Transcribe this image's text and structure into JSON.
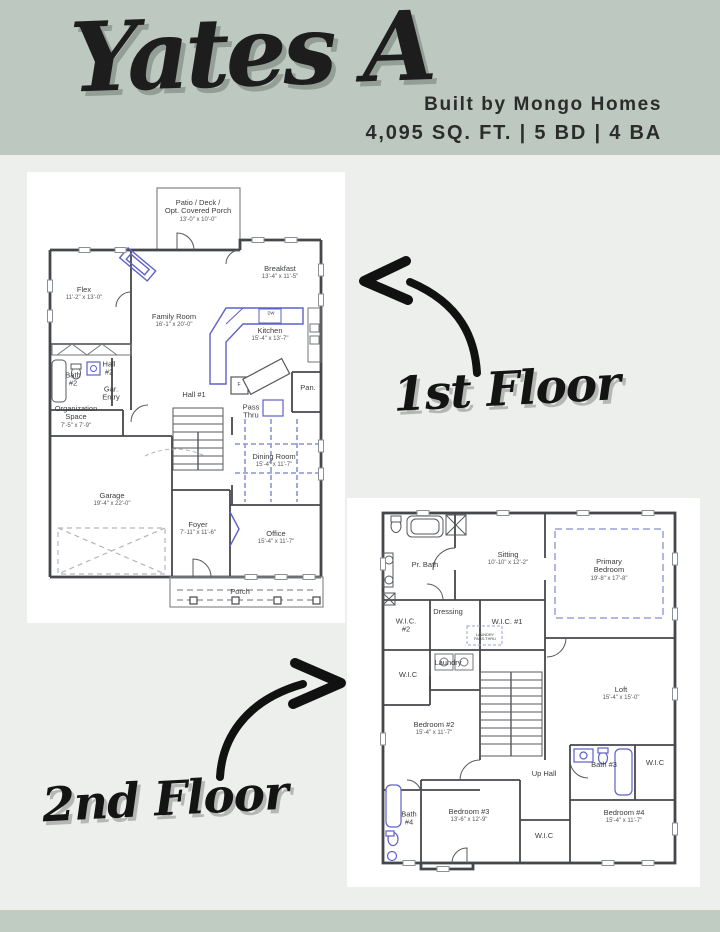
{
  "header": {
    "title": "Yates A",
    "builder": "Built by Mongo Homes",
    "specs": "4,095 SQ. FT. | 5 BD | 4 BA"
  },
  "annotations": {
    "floor1_label": "1st Floor",
    "floor2_label": "2nd Floor"
  },
  "colors": {
    "header_bg": "#bdc8c0",
    "body_bg": "#edefed",
    "footer_bg": "#c0cbc2",
    "panel_bg": "#ffffff",
    "wall": "#45474b",
    "fixture_blue": "#5d61c9",
    "ceiling_dash_blue": "#9aa0d8",
    "ink": "#1d1d1d"
  },
  "floor1": {
    "rooms": [
      {
        "name": "Patio / Deck /\nOpt. Covered Porch",
        "dims": "13'-0\" x 10'-0\"",
        "x": 171,
        "y": 39
      },
      {
        "name": "Flex",
        "dims": "11'-2\" x 13'-0\"",
        "x": 57,
        "y": 122
      },
      {
        "name": "Breakfast",
        "dims": "13'-4\" x 11'-5\"",
        "x": 253,
        "y": 101
      },
      {
        "name": "Family Room",
        "dims": "16'-1\" x 20'-0\"",
        "x": 147,
        "y": 149
      },
      {
        "name": "Kitchen",
        "dims": "15'-4\" x 13'-7\"",
        "x": 243,
        "y": 163
      },
      {
        "name": "DW",
        "x": 244,
        "y": 142,
        "size": 4.2
      },
      {
        "name": "F",
        "x": 212,
        "y": 214,
        "size": 5
      },
      {
        "name": "Bath\n#2",
        "x": 46,
        "y": 208
      },
      {
        "name": "Hall\n#2",
        "x": 82,
        "y": 197
      },
      {
        "name": "Pan.",
        "x": 281,
        "y": 216
      },
      {
        "name": "Gar.\nEntry",
        "x": 84,
        "y": 222
      },
      {
        "name": "Hall #1",
        "x": 167,
        "y": 223
      },
      {
        "name": "Pass\nThru",
        "x": 224,
        "y": 240
      },
      {
        "name": "Organization\nSpace",
        "dims": "7'-5\" x 7'-9\"",
        "x": 49,
        "y": 245
      },
      {
        "name": "Dining Room",
        "dims": "15'-4\" x 11'-7\"",
        "x": 247,
        "y": 289
      },
      {
        "name": "Garage",
        "dims": "19'-4\" x 22'-0\"",
        "x": 85,
        "y": 328
      },
      {
        "name": "Foyer",
        "dims": "7'-11\" x 11'-6\"",
        "x": 171,
        "y": 357
      },
      {
        "name": "Office",
        "dims": "15'-4\" x 11'-7\"",
        "x": 249,
        "y": 366
      },
      {
        "name": "Porch",
        "x": 213,
        "y": 420
      }
    ]
  },
  "floor2": {
    "rooms": [
      {
        "name": "Pr. Bath",
        "x": 78,
        "y": 67
      },
      {
        "name": "Sitting",
        "dims": "10'-10\" x 12'-2\"",
        "x": 161,
        "y": 61
      },
      {
        "name": "Primary\nBedroom",
        "dims": "19'-8\" x 17'-8\"",
        "x": 262,
        "y": 72
      },
      {
        "name": "Dressing",
        "x": 101,
        "y": 114
      },
      {
        "name": "W.I.C.\n#2",
        "x": 59,
        "y": 128
      },
      {
        "name": "W.I.C. #1",
        "x": 160,
        "y": 124
      },
      {
        "name": "LAUNDRY\nPASS-THRU",
        "x": 138,
        "y": 139,
        "size": 3.8
      },
      {
        "name": "Laundry",
        "x": 101,
        "y": 165
      },
      {
        "name": "W.I.C",
        "x": 61,
        "y": 177
      },
      {
        "name": "Loft",
        "dims": "15'-4\" x 15'-0\"",
        "x": 274,
        "y": 196
      },
      {
        "name": "Bedroom #2",
        "dims": "15'-4\" x 11'-7\"",
        "x": 87,
        "y": 231
      },
      {
        "name": "Up Hall",
        "x": 197,
        "y": 276
      },
      {
        "name": "Bath #3",
        "x": 257,
        "y": 267
      },
      {
        "name": "W.I.C",
        "x": 308,
        "y": 265
      },
      {
        "name": "Bath\n#4",
        "x": 62,
        "y": 321
      },
      {
        "name": "Bedroom #3",
        "dims": "13'-6\" x 12'-9\"",
        "x": 122,
        "y": 318
      },
      {
        "name": "W.I.C",
        "x": 197,
        "y": 338
      },
      {
        "name": "Bedroom #4",
        "dims": "15'-4\" x 11'-7\"",
        "x": 277,
        "y": 319
      }
    ]
  }
}
